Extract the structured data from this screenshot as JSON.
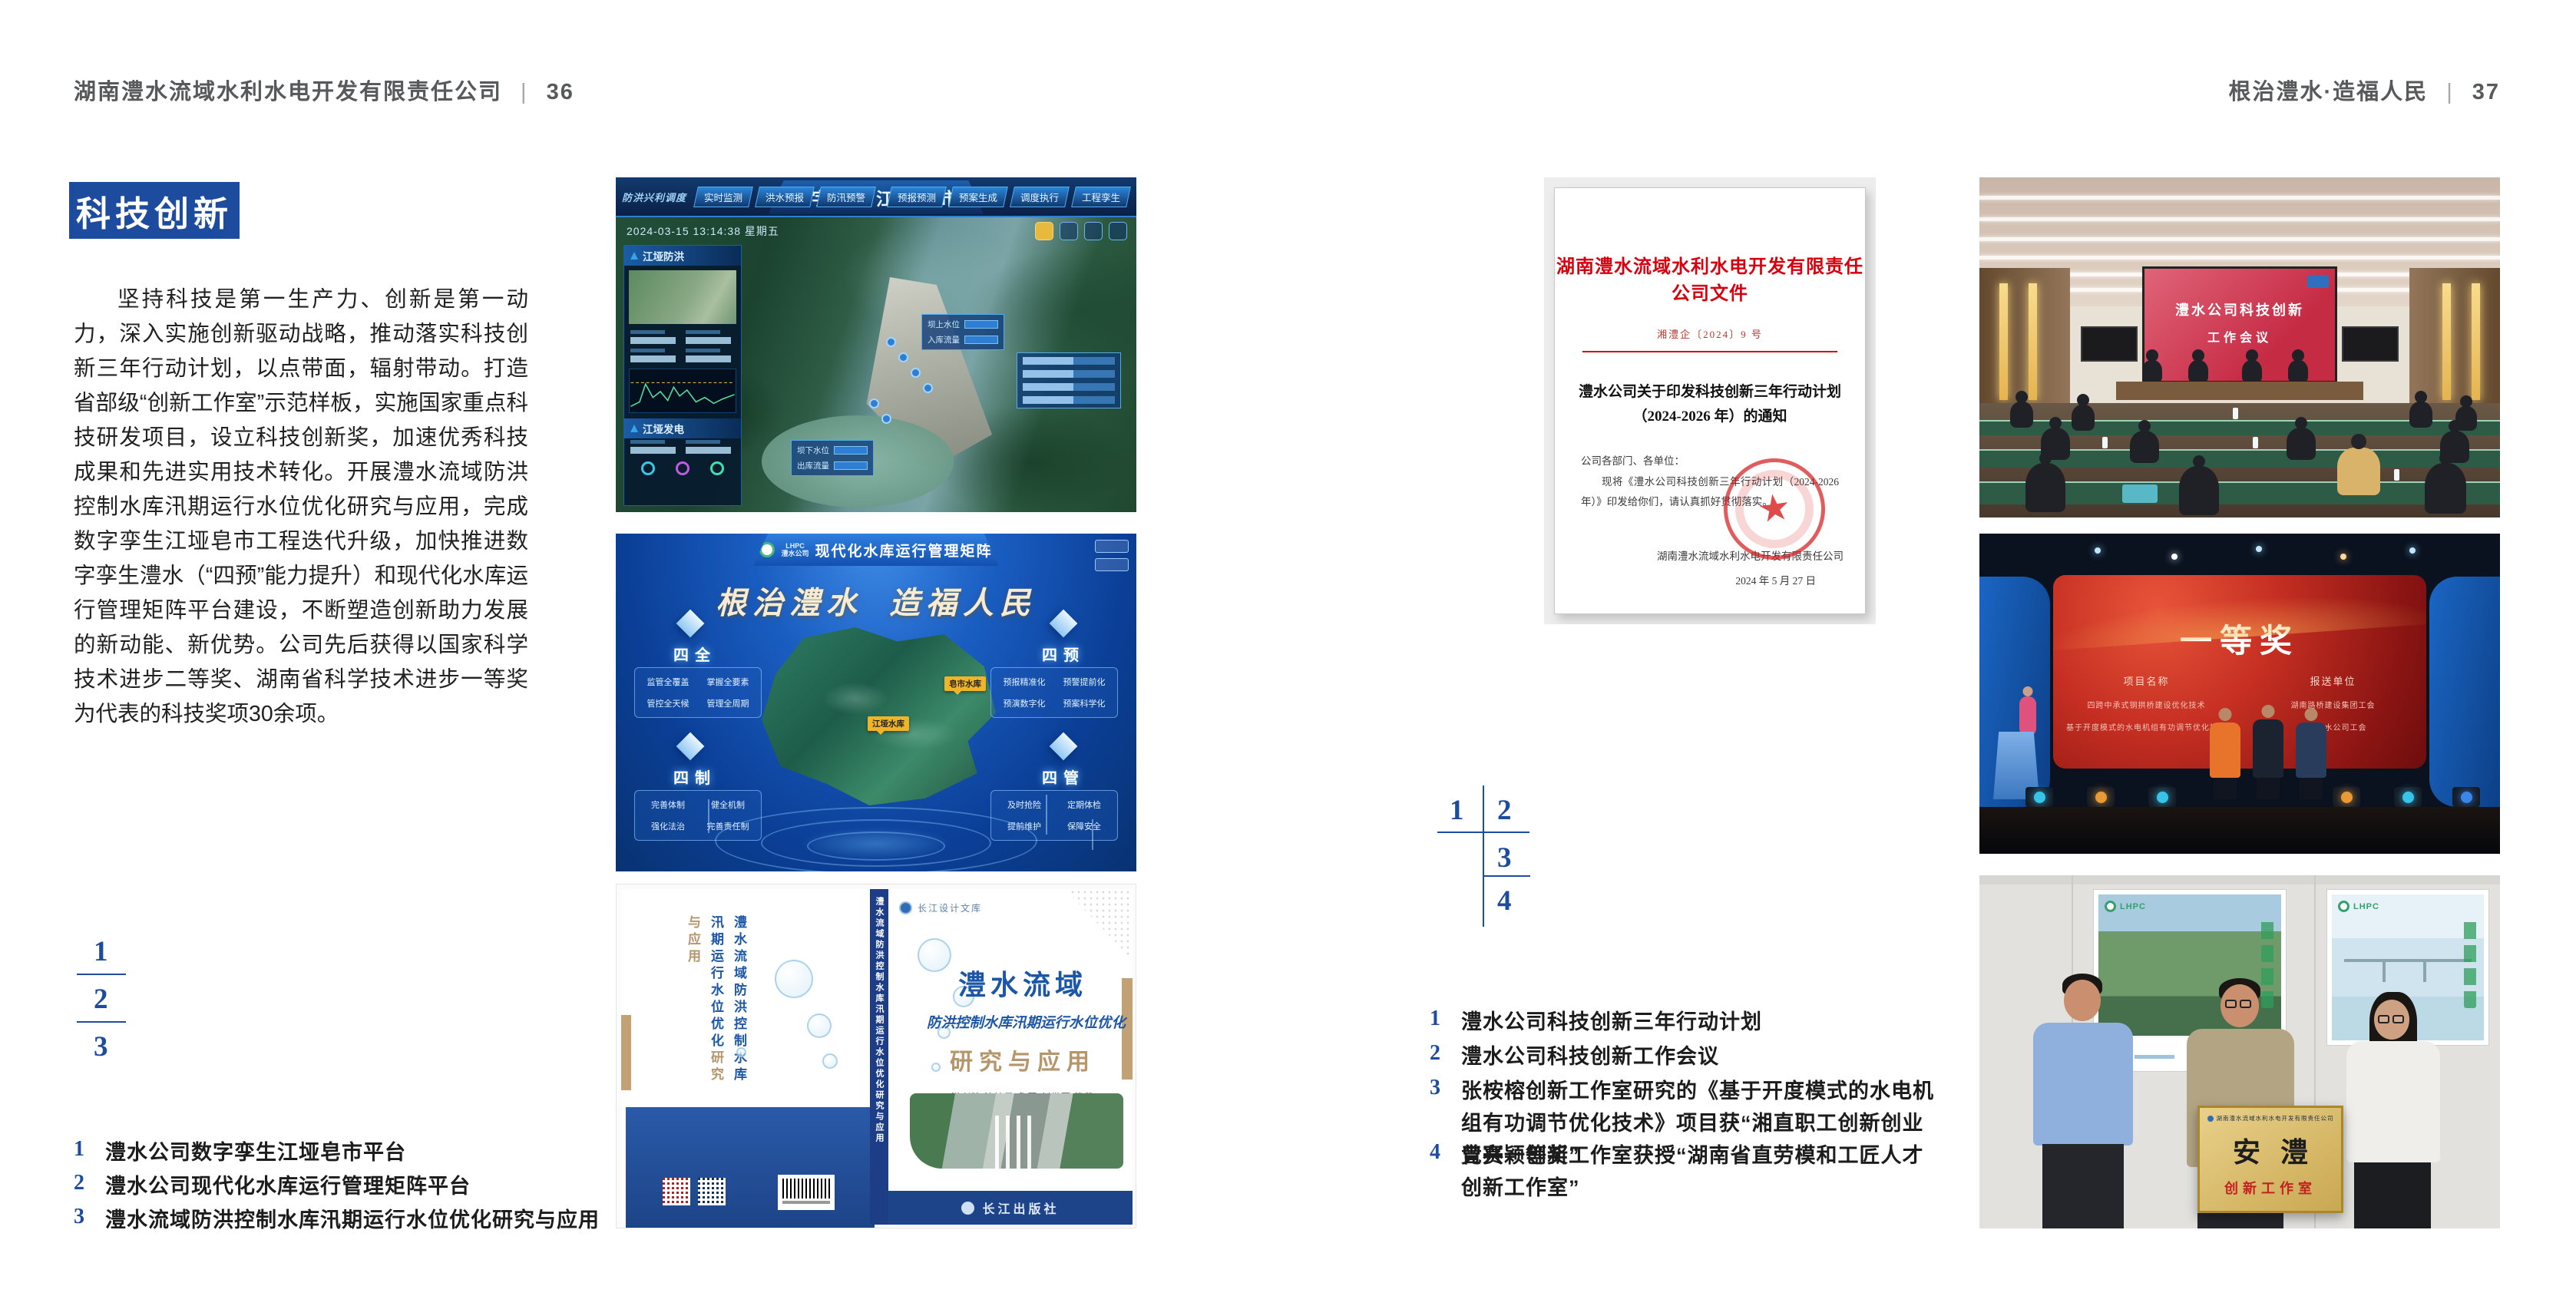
{
  "page_left": {
    "header_title": "湖南澧水流域水利水电开发有限责任公司",
    "header_sep": "|",
    "page_number": "36",
    "section_title": "科技创新",
    "body_text": "坚持科技是第一生产力、创新是第一动力，深入实施创新驱动战略，推动落实科技创新三年行动计划，以点带面，辐射带动。打造省部级“创新工作室”示范样板，实施国家重点科技研发项目，设立科技创新奖，加速优秀科技成果和先进实用技术转化。开展澧水流域防洪控制水库汛期运行水位优化研究与应用，完成数字孪生江垭皂市工程迭代升级，加快推进数字孪生澧水（“四预”能力提升）和现代化水库运行管理矩阵平台建设，不断塑造创新助力发展的新动能、新优势。公司先后获得以国家科学技术进步二等奖、湖南省科学技术进步一等奖为代表的科技奖项30余项。",
    "figure_index": [
      "1",
      "2",
      "3"
    ],
    "captions": [
      {
        "num": "1",
        "text": "澧水公司数字孪生江垭皂市平台"
      },
      {
        "num": "2",
        "text": "澧水公司现代化水库运行管理矩阵平台"
      },
      {
        "num": "3",
        "text": "澧水流域防洪控制水库汛期运行水位优化研究与应用"
      }
    ]
  },
  "page_right": {
    "header_title": "根治澧水·造福人民",
    "header_sep": "|",
    "page_number": "37",
    "figure_index": [
      "1",
      "2",
      "3",
      "4"
    ],
    "captions": [
      {
        "num": "1",
        "text": "澧水公司科技创新三年行动计划"
      },
      {
        "num": "2",
        "text": "澧水公司科技创新工作会议"
      },
      {
        "num": "3",
        "text": "张桉榕创新工作室研究的《基于开度模式的水电机组有功调节优化技术》项目获“湘直职工创新创业竞赛一等奖”"
      },
      {
        "num": "4",
        "text": "曾兴颖创新工作室获授“湖南省直劳模和工匠人才创新工作室”"
      }
    ]
  },
  "figures": {
    "twin": {
      "title": "数字孪生江垭皂市",
      "timestamp": "2024-03-15 13:14:38 星期五",
      "corner_label": "防洪兴利调度",
      "tabs_left": [
        "实时监测",
        "洪水预报",
        "防汛预警"
      ],
      "tabs_right": [
        "预报预测",
        "预案生成",
        "调度执行",
        "工程孪生"
      ],
      "panel_flood_title": "江垭防洪",
      "panel_power_title": "江垭发电",
      "callout1_labels": [
        "坝上水位",
        "入库流量"
      ],
      "callout3_labels": [
        "坝下水位",
        "出库流量"
      ]
    },
    "matrix": {
      "logo_text": "LHPC",
      "logo_sub": "澧水公司",
      "title": "现代化水库运行管理矩阵",
      "slogan_left": "根治澧水",
      "slogan_right": "造福人民",
      "groups": [
        {
          "title": "四全",
          "items": [
            "监管全覆盖",
            "掌握全要素",
            "管控全天候",
            "管理全周期"
          ]
        },
        {
          "title": "四预",
          "items": [
            "预报精准化",
            "预警提前化",
            "预演数字化",
            "预案科学化"
          ]
        },
        {
          "title": "四制",
          "items": [
            "完善体制",
            "健全机制",
            "强化法治",
            "完善责任制"
          ]
        },
        {
          "title": "四管",
          "items": [
            "及时抢险",
            "定期体检",
            "提前维护",
            "保障安全"
          ]
        }
      ],
      "map_labels": [
        "皂市水库",
        "江垭水库"
      ]
    },
    "book": {
      "series_badge": "长江设计文库",
      "back_title": "澧水流域防洪控制水库汛期运行水位优化",
      "back_subtitle": "研究与应用",
      "spine_text": "澧水流域防洪控制水库汛期运行水位优化研究与应用",
      "title_line1": "澧水流域",
      "title_line2": "防洪控制水库汛期运行水位优化",
      "title_line3": "研究与应用",
      "authors": "洪兴骏 沈坤民 鲁军 刘世军 等著",
      "publisher": "长江出版社"
    },
    "document": {
      "header": "湖南澧水流域水利水电开发有限责任公司文件",
      "doc_number": "湘澧企〔2024〕9 号",
      "title_line1": "澧水公司关于印发科技创新三年行动计划",
      "title_line2": "（2024-2026 年）的通知",
      "salutation": "公司各部门、各单位：",
      "body": "现将《澧水公司科技创新三年行动计划（2024-2026 年）》印发给你们，请认真抓好贯彻落实。",
      "signer": "湖南澧水流域水利水电开发有限责任公司",
      "date": "2024 年 5 月 27 日"
    },
    "meeting": {
      "screen_line1": "澧水公司科技创新",
      "screen_line2": "工作会议"
    },
    "award": {
      "screen_title": "一等奖",
      "col1_header": "项目名称",
      "col2_header": "报送单位",
      "col1_items": [
        "四跨中承式钢拱桥建设优化技术",
        "基于开度模式的水电机组有功调节优化技术"
      ],
      "col2_items": [
        "湖南路桥建设集团工会",
        "湖南澧水公司工会"
      ]
    },
    "group": {
      "poster_logo": "LHPC",
      "plaque_header": "湖南澧水流域水利水电开发有限责任公司",
      "plaque_title": "安澧",
      "plaque_subtitle": "创新工作室"
    }
  },
  "colors": {
    "accent_blue": "#1d4c9e",
    "document_red": "#d6000f",
    "book_blue": "#1c57a5",
    "book_tan": "#b5956a"
  }
}
